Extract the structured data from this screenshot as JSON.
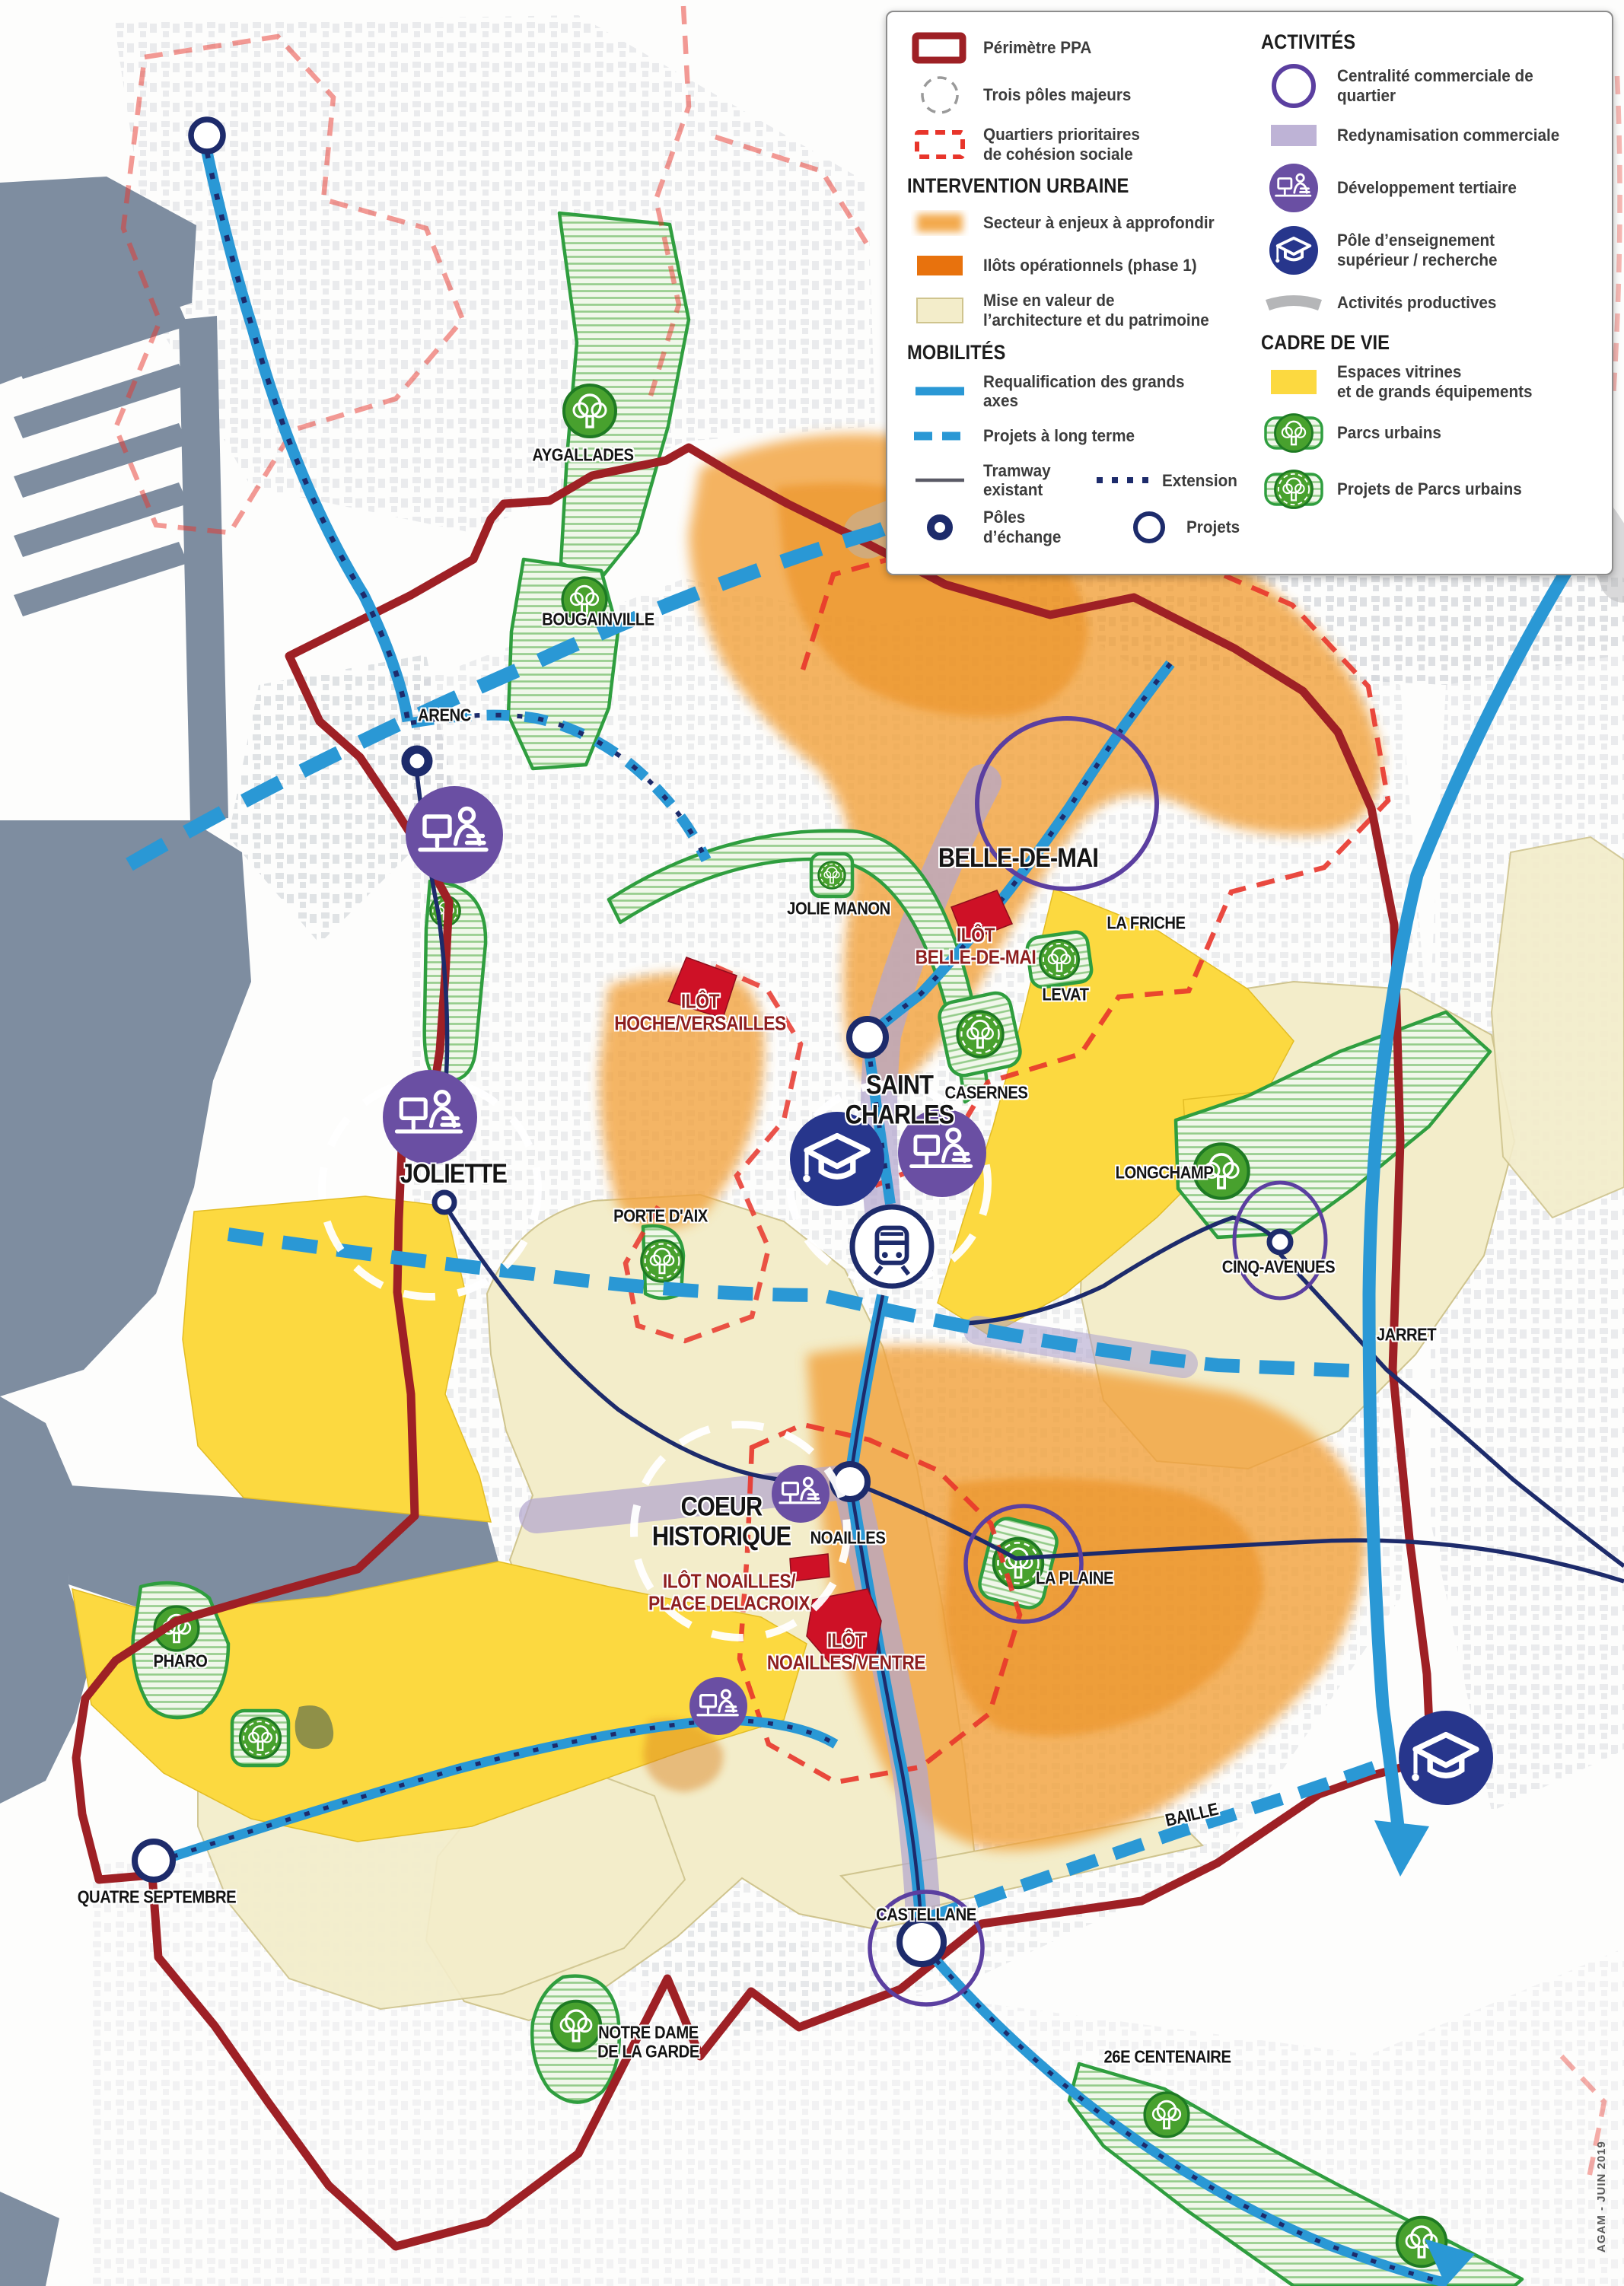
{
  "legend": {
    "items": {
      "perimetre": {
        "label": "Périmètre PPA"
      },
      "poles": {
        "label": "Trois pôles majeurs"
      },
      "qpv": {
        "label": "Quartiers prioritaires\nde cohésion sociale"
      },
      "head_iu": {
        "label": "INTERVENTION URBAINE"
      },
      "secteur": {
        "label": "Secteur à enjeux à approfondir"
      },
      "ilots": {
        "label": "Ilôts opérationnels (phase 1)"
      },
      "mise": {
        "label": "Mise en valeur de\nl’architecture et du patrimoine"
      },
      "head_mob": {
        "label": "MOBILITÉS"
      },
      "requal": {
        "label": "Requalification des grands axes"
      },
      "projets_lt": {
        "label": "Projets à long terme"
      },
      "tram": {
        "label": "Tramway existant"
      },
      "extension": {
        "label": "Extension"
      },
      "poles_ech": {
        "label": "Pôles d’échange"
      },
      "projets": {
        "label": "Projets"
      },
      "head_act": {
        "label": "ACTIVITÉS"
      },
      "centralite": {
        "label": "Centralité commerciale de quartier"
      },
      "redyn": {
        "label": "Redynamisation commerciale"
      },
      "tertiaire": {
        "label": "Développement tertiaire"
      },
      "enseignement": {
        "label": "Pôle d’enseignement\nsupérieur / recherche"
      },
      "productives": {
        "label": "Activités productives"
      },
      "head_cdv": {
        "label": "CADRE DE VIE"
      },
      "vitrines": {
        "label": "Espaces vitrines\net de grands équipements"
      },
      "parcs": {
        "label": "Parcs urbains"
      },
      "projets_parcs": {
        "label": "Projets de Parcs urbains"
      }
    }
  },
  "map": {
    "credit": "AGAM - JUIN 2019",
    "colors": {
      "ppa": "#9e2025",
      "qpv": "#e8352b",
      "blue": "#2a98d5",
      "navy": "#1d2b6b",
      "purple_ring": "#5b3fa0",
      "tertiaire": "#6a4fa3",
      "enseignement": "#27368c",
      "orange": "#f2a13a",
      "ilots_rouges": "#ce1126",
      "cream": "#f3edca",
      "yellow": "#fcd940",
      "lavender": "#b3a6cf",
      "gray_band": "#b5b6b8",
      "park_green": "#2f9e3f",
      "sea": "#7e8da0"
    },
    "labels": {
      "aygallades": {
        "text": "AYGALLADES"
      },
      "bougainville": {
        "text": "BOUGAINVILLE"
      },
      "arenc": {
        "text": "ARENC"
      },
      "jolie_manon": {
        "text": "JOLIE MANON"
      },
      "belle_de_mai": {
        "text": "BELLE-DE-MAI"
      },
      "la_friche": {
        "text": "LA FRICHE"
      },
      "levat": {
        "text": "LEVAT"
      },
      "casernes": {
        "text": "CASERNES"
      },
      "saint_charles": {
        "text": "SAINT\nCHARLES"
      },
      "joliette": {
        "text": "JOLIETTE"
      },
      "porte_daix": {
        "text": "PORTE D'AIX"
      },
      "longchamp": {
        "text": "LONGCHAMP"
      },
      "cinq_avenues": {
        "text": "CINQ-AVENUES"
      },
      "jarret": {
        "text": "JARRET"
      },
      "la_plaine": {
        "text": "LA PLAINE"
      },
      "coeur_historique": {
        "text": "COEUR\nHISTORIQUE"
      },
      "noailles": {
        "text": "NOAILLES"
      },
      "castellane": {
        "text": "CASTELLANE"
      },
      "baille": {
        "text": "BAILLE"
      },
      "quatre_septembre": {
        "text": "QUATRE SEPTEMBRE"
      },
      "pharo": {
        "text": "PHARO"
      },
      "notre_dame": {
        "text": "NOTRE DAME\nDE LA GARDE"
      },
      "centenaire": {
        "text": "26E CENTENAIRE"
      },
      "ilot_hoche": {
        "text": "ILÔT\nHOCHE/VERSAILLES"
      },
      "ilot_bdm": {
        "text": "ILÔT\nBELLE-DE-MAI"
      },
      "ilot_delacroix": {
        "text": "ILÔT NOAILLES/\nPLACE DELACROIX"
      },
      "ilot_ventre": {
        "text": "ILÔT\nNOAILLES/VENTRE"
      }
    }
  }
}
